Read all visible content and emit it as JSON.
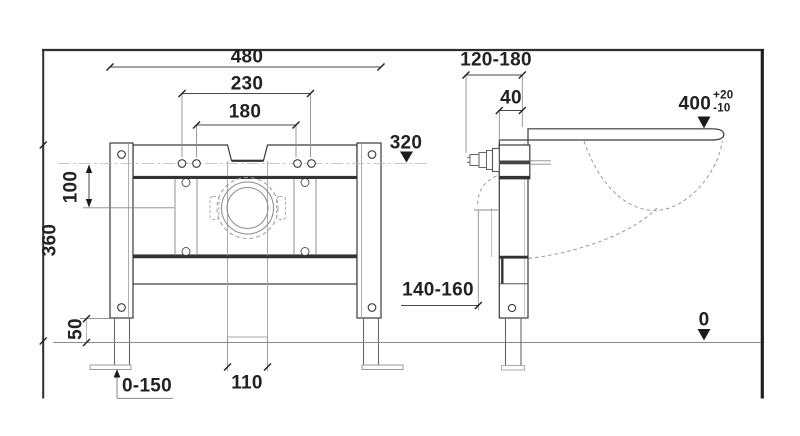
{
  "drawing": {
    "description": "Installation dimension drawing of a wall-mounted toilet support frame, front view and side view, values in mm",
    "front_view": {
      "dimensions": {
        "overall_width": "480",
        "hole_spacing_outer": "230",
        "hole_spacing_inner": "180",
        "top_fixing_level": "320",
        "hole_row_offset": "100",
        "frame_height": "360",
        "leg_height": "50",
        "leg_adjustment_range": "0-150",
        "drain_channel_width": "110"
      }
    },
    "side_view": {
      "dimensions": {
        "wall_clearance_range": "120-180",
        "rail_depth": "40",
        "seat_height": {
          "value": "400",
          "tolerance_plus": "+20",
          "tolerance_minus": "-10"
        },
        "drain_connection_height_range": "140-160",
        "floor_level": "0"
      }
    }
  }
}
